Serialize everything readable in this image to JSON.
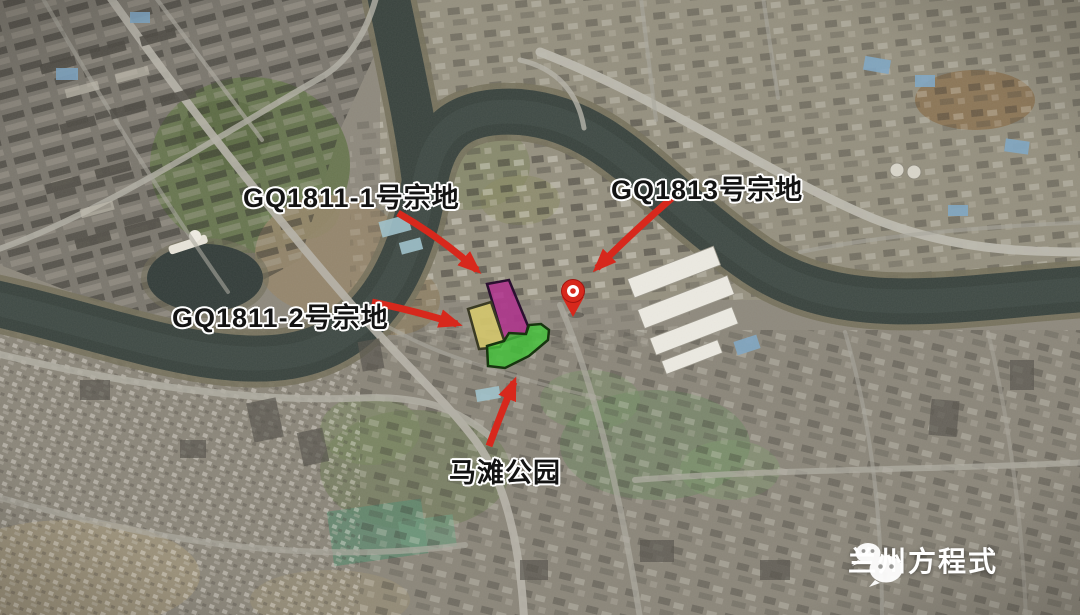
{
  "labels": {
    "gq1811_1": "GQ1811-1号宗地",
    "gq1813": "GQ1813号宗地",
    "gq1811_2": "GQ1811-2号宗地",
    "matan_park": "马滩公园"
  },
  "annotations": [
    {
      "label": "GQ1811-1号宗地",
      "marker": "magenta parcel outline",
      "arrow": "points down-right to parcel"
    },
    {
      "label": "GQ1811-2号宗地",
      "marker": "yellow parcel outline",
      "arrow": "points right to parcel"
    },
    {
      "label": "GQ1813号宗地",
      "marker": "red location pin",
      "arrow": "points down-left to pin"
    },
    {
      "label": "马滩公园",
      "marker": "green parcel outline",
      "arrow": "points up to parcel"
    }
  ],
  "watermark": {
    "icon": "wechat-icon",
    "text": "兰州方程式"
  },
  "colors": {
    "annotation_red": "#d7281c",
    "parcel_magenta": "#b12d8e",
    "parcel_yellow": "#d9cb6c",
    "parcel_green": "#41c438",
    "label_text": "#131313",
    "label_outline": "#ffffff",
    "watermark_text": "#ffffff"
  }
}
